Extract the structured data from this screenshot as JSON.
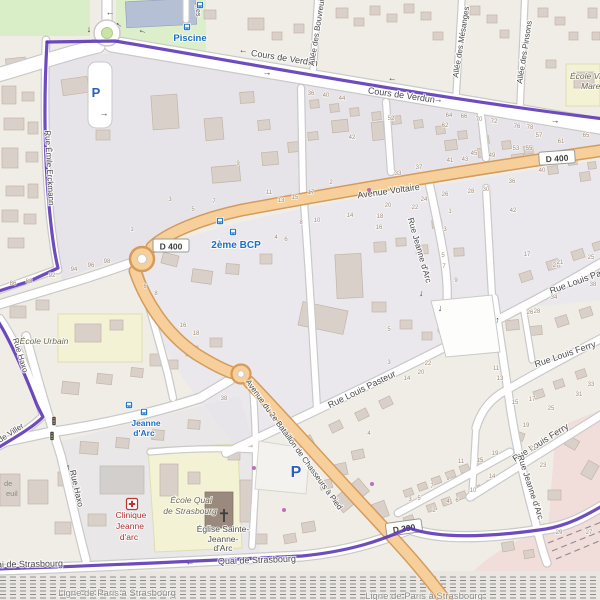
{
  "app": {
    "title": "OpenStreetMap-style map view",
    "area": "Quartier Cours de Verdun / Avenue Voltaire"
  },
  "colors": {
    "boundary_purple": "#5b33b5",
    "primary_road_fill": "#f6cf9b",
    "primary_road_casing": "#d59b5b",
    "road_white": "#ffffff",
    "road_casing": "#c9c9c9",
    "building": "#d9d0c9",
    "building_outline": "#c3b5a8",
    "school_yellow": "#f4f2d4",
    "park_green": "#d9edc6",
    "landuse_gray": "#e2e0e9",
    "station_pink": "#f1dedb",
    "transit_blue": "#1a70c7",
    "clinic_red": "#b03030",
    "railway_gray": "#8c8c8c",
    "background": "#f0ede7"
  },
  "streets": [
    {
      "t": "Cours de Verdun",
      "x": 284,
      "y": 61,
      "r": 9,
      "s": 9
    },
    {
      "t": "Cours de Verdun",
      "x": 401,
      "y": 98,
      "r": 8,
      "s": 9
    },
    {
      "t": "Avenue Voltaire",
      "x": 389,
      "y": 194,
      "r": -8,
      "s": 9
    },
    {
      "t": "Rue Jeanne d'Arc",
      "x": 417,
      "y": 251,
      "r": 74,
      "s": 8.5
    },
    {
      "t": "Rue Louis Pasteur",
      "x": 363,
      "y": 392,
      "r": -26,
      "s": 9
    },
    {
      "t": "Rue Louis Pasteur",
      "x": 551,
      "y": 294,
      "r": -20,
      "s": 9,
      "a": "s"
    },
    {
      "t": "Rue Louis Ferry",
      "x": 566,
      "y": 357,
      "r": -19,
      "s": 9
    },
    {
      "t": "Rue Louis Ferry",
      "x": 542,
      "y": 445,
      "r": -32,
      "s": 9
    },
    {
      "t": "Rue Jeanne d'Arc",
      "x": 528,
      "y": 488,
      "r": 72,
      "s": 8.5
    },
    {
      "t": "Avenue du 2e Bataillon de Chasseurs à Pied",
      "x": 292,
      "y": 446,
      "r": 54,
      "s": 8
    },
    {
      "t": "Rue Haxo",
      "x": 18,
      "y": 356,
      "r": 73,
      "s": 8
    },
    {
      "t": "Rue Haxo",
      "x": 74,
      "y": 489,
      "r": 77,
      "s": 8.5
    },
    {
      "t": "Rue de Viller",
      "x": -14,
      "y": 452,
      "r": -33,
      "s": 8,
      "a": "s"
    },
    {
      "t": "Rue Émile Erckmann",
      "x": 47,
      "y": 168,
      "r": 87,
      "s": 8
    },
    {
      "t": "Quai de Strasbourg",
      "x": 257,
      "y": 563,
      "r": -2,
      "s": 9
    },
    {
      "t": "Quai de Strasbourg",
      "x": 24,
      "y": 567,
      "r": -1,
      "s": 9
    },
    {
      "t": "Allée des Bouvreuils",
      "x": 314,
      "y": 66,
      "r": -81,
      "s": 8,
      "a": "s"
    },
    {
      "t": "Allée des Mésanges",
      "x": 458,
      "y": 78,
      "r": -81,
      "s": 8,
      "a": "s"
    },
    {
      "t": "Allée des Pinsons",
      "x": 522,
      "y": 84,
      "r": -81,
      "s": 8,
      "a": "s"
    },
    {
      "t": "nes",
      "x": 196,
      "y": 11,
      "r": 84,
      "s": 7
    }
  ],
  "railway_labels": [
    {
      "t": "Ligne de Paris à Strasbourg",
      "x": 117,
      "y": 596
    },
    {
      "t": "Ligne de Paris à Strasbourg",
      "x": 424,
      "y": 599
    }
  ],
  "transit_labels": [
    {
      "t": "Piscine",
      "x": 190,
      "y": 41,
      "s": 9.5
    },
    {
      "t": "2ème BCP",
      "x": 236,
      "y": 248,
      "s": 10
    },
    {
      "t": "Jeanne",
      "x": 146,
      "y": 426,
      "s": 8.5
    },
    {
      "t": "d'Arc",
      "x": 144,
      "y": 436,
      "s": 8.5
    }
  ],
  "school_labels": [
    {
      "t": "École Urbain",
      "x": 44,
      "y": 344
    },
    {
      "t": "École Quai",
      "x": 191,
      "y": 503
    },
    {
      "t": "de Strasbourg",
      "x": 190,
      "y": 514
    },
    {
      "t": "École Villebois",
      "x": 570,
      "y": 79,
      "a": "s"
    },
    {
      "t": "Mareuil",
      "x": 581,
      "y": 89,
      "a": "s"
    }
  ],
  "clinic_labels": [
    {
      "t": "Clinique",
      "x": 131,
      "y": 518
    },
    {
      "t": "Jeanne",
      "x": 130,
      "y": 529
    },
    {
      "t": "d'arc",
      "x": 129,
      "y": 540
    }
  ],
  "church_labels": [
    {
      "t": "Église Sainte-",
      "x": 223,
      "y": 532
    },
    {
      "t": "Jeanne-",
      "x": 223,
      "y": 542
    },
    {
      "t": "d'Arc",
      "x": 223,
      "y": 551
    }
  ],
  "fragments": [
    {
      "t": "de",
      "x": 4,
      "y": 486
    },
    {
      "t": "euil",
      "x": 6,
      "y": 496
    }
  ],
  "route_badges": [
    {
      "t": "D 400",
      "x": 171,
      "y": 246,
      "r": 0,
      "under": false
    },
    {
      "t": "D 400",
      "x": 557,
      "y": 158,
      "r": -4,
      "under": false
    },
    {
      "t": "D 390",
      "x": 404,
      "y": 528,
      "r": -8,
      "under": true
    }
  ],
  "house_numbers": [
    {
      "n": "36",
      "x": 311,
      "y": 95
    },
    {
      "n": "40",
      "x": 326,
      "y": 97
    },
    {
      "n": "44",
      "x": 342,
      "y": 100
    },
    {
      "n": "52",
      "x": 391,
      "y": 120
    },
    {
      "n": "62",
      "x": 445,
      "y": 127
    },
    {
      "n": "64",
      "x": 449,
      "y": 117
    },
    {
      "n": "66",
      "x": 464,
      "y": 118
    },
    {
      "n": "70",
      "x": 479,
      "y": 121
    },
    {
      "n": "72",
      "x": 494,
      "y": 123
    },
    {
      "n": "76",
      "x": 517,
      "y": 128
    },
    {
      "n": "78",
      "x": 530,
      "y": 129
    },
    {
      "n": "42",
      "x": 352,
      "y": 139
    },
    {
      "n": "45",
      "x": 474,
      "y": 155
    },
    {
      "n": "49",
      "x": 492,
      "y": 157
    },
    {
      "n": "53",
      "x": 516,
      "y": 150
    },
    {
      "n": "55",
      "x": 529,
      "y": 150
    },
    {
      "n": "41",
      "x": 450,
      "y": 162
    },
    {
      "n": "43",
      "x": 465,
      "y": 161
    },
    {
      "n": "57",
      "x": 539,
      "y": 137
    },
    {
      "n": "61",
      "x": 561,
      "y": 143
    },
    {
      "n": "65",
      "x": 586,
      "y": 137
    },
    {
      "n": "40",
      "x": 542,
      "y": 172
    },
    {
      "n": "86",
      "x": 13,
      "y": 285
    },
    {
      "n": "88",
      "x": 29,
      "y": 283
    },
    {
      "n": "92",
      "x": 52,
      "y": 277
    },
    {
      "n": "94",
      "x": 74,
      "y": 271
    },
    {
      "n": "96",
      "x": 91,
      "y": 267
    },
    {
      "n": "98",
      "x": 107,
      "y": 263
    },
    {
      "n": "1",
      "x": 132,
      "y": 231
    },
    {
      "n": "3",
      "x": 170,
      "y": 201
    },
    {
      "n": "5",
      "x": 193,
      "y": 211
    },
    {
      "n": "7",
      "x": 214,
      "y": 203
    },
    {
      "n": "9",
      "x": 238,
      "y": 165
    },
    {
      "n": "11",
      "x": 269,
      "y": 194
    },
    {
      "n": "13",
      "x": 281,
      "y": 202
    },
    {
      "n": "15",
      "x": 295,
      "y": 199
    },
    {
      "n": "4",
      "x": 276,
      "y": 239
    },
    {
      "n": "6",
      "x": 286,
      "y": 241
    },
    {
      "n": "6",
      "x": 145,
      "y": 288
    },
    {
      "n": "8",
      "x": 156,
      "y": 295
    },
    {
      "n": "17",
      "x": 311,
      "y": 194
    },
    {
      "n": "2",
      "x": 331,
      "y": 184
    },
    {
      "n": "33",
      "x": 398,
      "y": 175
    },
    {
      "n": "37",
      "x": 419,
      "y": 169
    },
    {
      "n": "24",
      "x": 424,
      "y": 201
    },
    {
      "n": "22",
      "x": 415,
      "y": 209
    },
    {
      "n": "20",
      "x": 388,
      "y": 207
    },
    {
      "n": "26",
      "x": 445,
      "y": 196
    },
    {
      "n": "28",
      "x": 471,
      "y": 193
    },
    {
      "n": "30",
      "x": 486,
      "y": 191
    },
    {
      "n": "36",
      "x": 512,
      "y": 183
    },
    {
      "n": "42",
      "x": 513,
      "y": 212
    },
    {
      "n": "16",
      "x": 379,
      "y": 229
    },
    {
      "n": "14",
      "x": 350,
      "y": 217
    },
    {
      "n": "18",
      "x": 380,
      "y": 218
    },
    {
      "n": "8",
      "x": 301,
      "y": 224
    },
    {
      "n": "10",
      "x": 317,
      "y": 222
    },
    {
      "n": "1",
      "x": 450,
      "y": 213
    },
    {
      "n": "3",
      "x": 445,
      "y": 231
    },
    {
      "n": "5",
      "x": 443,
      "y": 257
    },
    {
      "n": "7",
      "x": 444,
      "y": 268
    },
    {
      "n": "9",
      "x": 456,
      "y": 282
    },
    {
      "n": "17",
      "x": 527,
      "y": 256
    },
    {
      "n": "27",
      "x": 556,
      "y": 267
    },
    {
      "n": "25",
      "x": 591,
      "y": 259
    },
    {
      "n": "38",
      "x": 593,
      "y": 286
    },
    {
      "n": "34",
      "x": 554,
      "y": 299
    },
    {
      "n": "26",
      "x": 530,
      "y": 314
    },
    {
      "n": "28",
      "x": 537,
      "y": 313
    },
    {
      "n": "21",
      "x": 560,
      "y": 264
    },
    {
      "n": "16",
      "x": 183,
      "y": 327
    },
    {
      "n": "18",
      "x": 196,
      "y": 335
    },
    {
      "n": "38",
      "x": 224,
      "y": 400
    },
    {
      "n": "5",
      "x": 389,
      "y": 331
    },
    {
      "n": "3",
      "x": 389,
      "y": 364
    },
    {
      "n": "22",
      "x": 428,
      "y": 365
    },
    {
      "n": "20",
      "x": 421,
      "y": 374
    },
    {
      "n": "14",
      "x": 407,
      "y": 380
    },
    {
      "n": "11",
      "x": 496,
      "y": 370
    },
    {
      "n": "13",
      "x": 500,
      "y": 380
    },
    {
      "n": "15",
      "x": 515,
      "y": 404
    },
    {
      "n": "17",
      "x": 532,
      "y": 401
    },
    {
      "n": "25",
      "x": 551,
      "y": 410
    },
    {
      "n": "19",
      "x": 526,
      "y": 427
    },
    {
      "n": "31",
      "x": 579,
      "y": 396
    },
    {
      "n": "33",
      "x": 591,
      "y": 386
    },
    {
      "n": "4",
      "x": 369,
      "y": 435
    },
    {
      "n": "19",
      "x": 495,
      "y": 455
    },
    {
      "n": "23",
      "x": 543,
      "y": 467
    },
    {
      "n": "11",
      "x": 461,
      "y": 463
    },
    {
      "n": "15",
      "x": 480,
      "y": 462
    },
    {
      "n": "14",
      "x": 492,
      "y": 478
    },
    {
      "n": "7",
      "x": 432,
      "y": 488
    },
    {
      "n": "9",
      "x": 448,
      "y": 480
    },
    {
      "n": "3",
      "x": 410,
      "y": 501
    },
    {
      "n": "5",
      "x": 419,
      "y": 500
    },
    {
      "n": "2",
      "x": 434,
      "y": 512
    },
    {
      "n": "4",
      "x": 448,
      "y": 503
    },
    {
      "n": "6",
      "x": 457,
      "y": 502
    },
    {
      "n": "10",
      "x": 473,
      "y": 492
    },
    {
      "n": "29",
      "x": 559,
      "y": 534
    },
    {
      "n": "27",
      "x": 589,
      "y": 534
    },
    {
      "n": "21",
      "x": 533,
      "y": 450
    }
  ],
  "oneway_arrows": [
    {
      "g": "←",
      "x": 243,
      "y": 53,
      "r": 9
    },
    {
      "g": "→",
      "x": 267,
      "y": 75,
      "r": 9
    },
    {
      "g": "←",
      "x": 392,
      "y": 81,
      "r": 9
    },
    {
      "g": "→",
      "x": 555,
      "y": 123,
      "r": 9
    },
    {
      "g": "→",
      "x": 438,
      "y": 102,
      "r": 8
    },
    {
      "g": "←",
      "x": 110,
      "y": 15,
      "r": 0
    },
    {
      "g": "←",
      "x": 118,
      "y": 26,
      "r": 38
    },
    {
      "g": "←",
      "x": 142,
      "y": 33,
      "r": 18
    },
    {
      "g": "↓",
      "x": 89,
      "y": 32,
      "r": 0
    },
    {
      "g": "→",
      "x": 104,
      "y": 116,
      "r": 0
    },
    {
      "g": "↓",
      "x": 421,
      "y": 296,
      "r": 12
    },
    {
      "g": "↓",
      "x": 440,
      "y": 311,
      "r": 5
    },
    {
      "g": "↑",
      "x": 497,
      "y": 323,
      "r": 8
    },
    {
      "g": "←",
      "x": 67,
      "y": 468,
      "r": 78
    },
    {
      "g": "←",
      "x": 190,
      "y": 565,
      "r": -2
    }
  ],
  "icons": {
    "bus_stops": [
      [
        200,
        5
      ],
      [
        187,
        27
      ],
      [
        220,
        221
      ],
      [
        233,
        232
      ],
      [
        129,
        405
      ],
      [
        144,
        412
      ]
    ],
    "traffic_signals": [
      [
        54,
        421
      ],
      [
        52,
        436
      ]
    ],
    "parking": [
      {
        "x": 96,
        "y": 97,
        "s": 13
      },
      {
        "x": 296,
        "y": 477,
        "s": 16
      }
    ],
    "hospital": [
      132,
      504
    ],
    "church_cross": [
      224,
      516
    ],
    "poi_dots": [
      [
        369,
        190
      ],
      [
        254,
        468
      ],
      [
        284,
        510
      ],
      [
        372,
        484
      ]
    ]
  }
}
